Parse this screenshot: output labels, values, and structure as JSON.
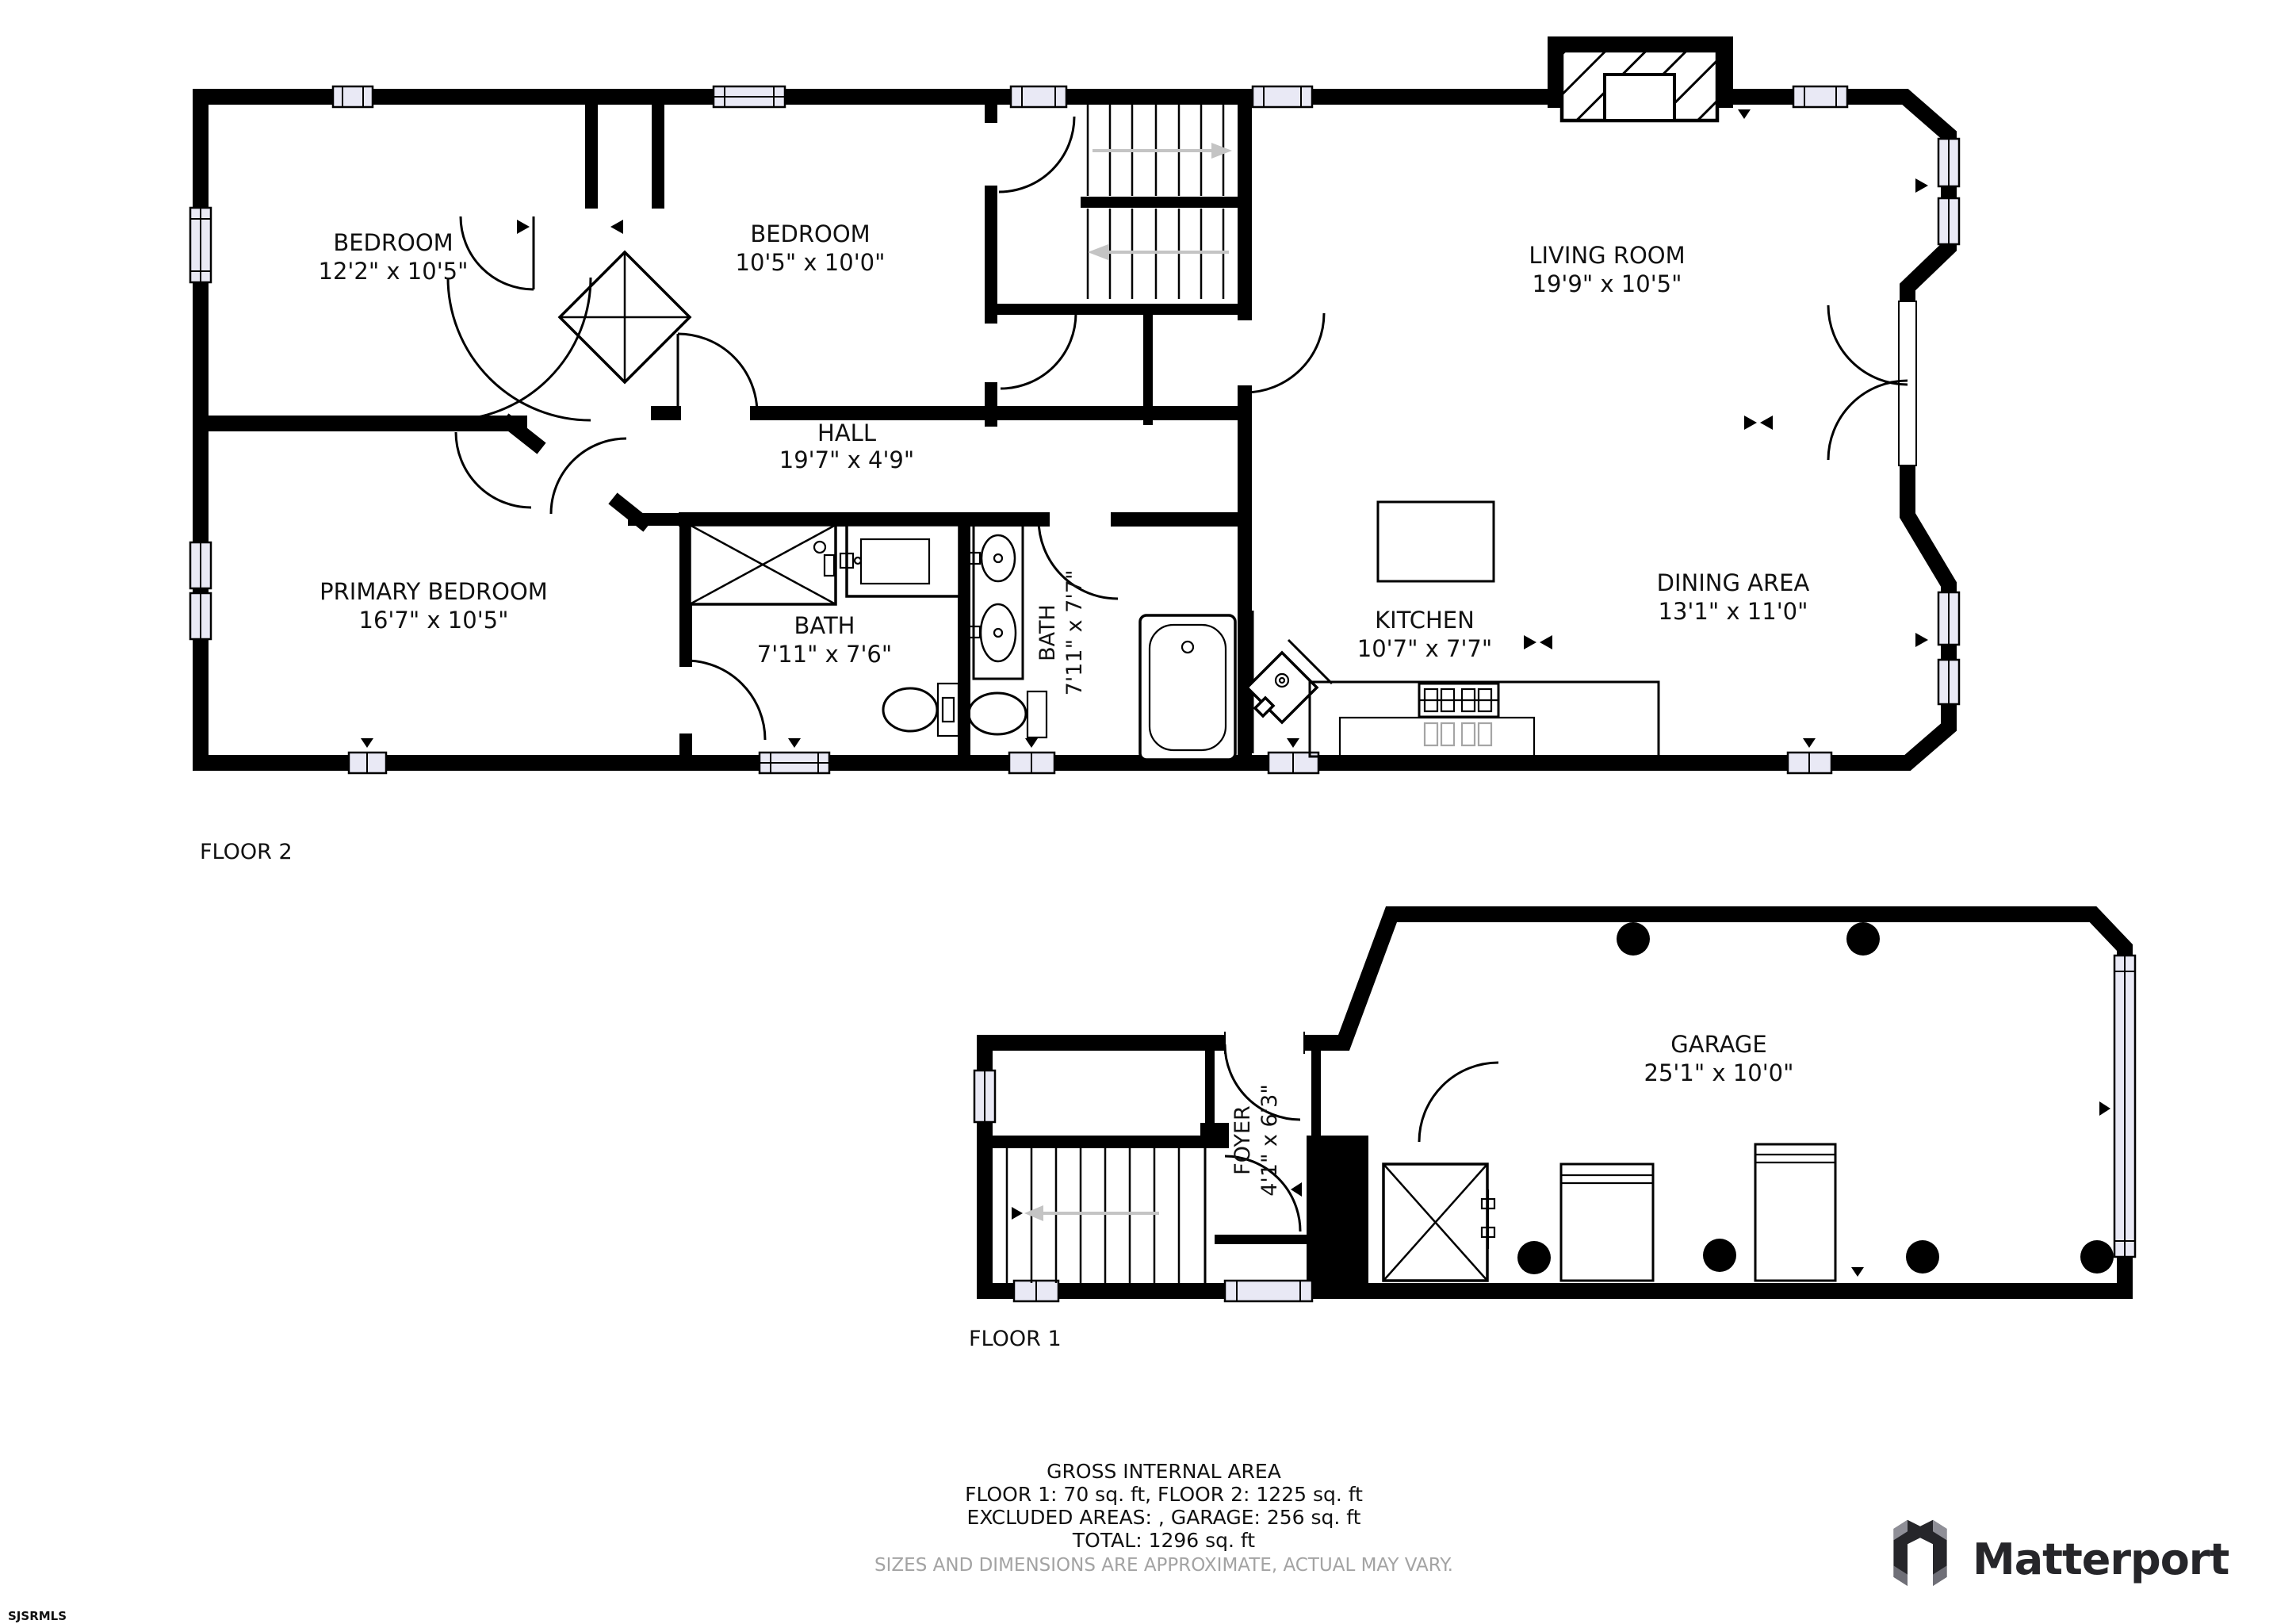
{
  "floor2": {
    "label": "FLOOR 2",
    "rooms": {
      "bedroom1": {
        "name": "BEDROOM",
        "dims": "12'2\" x 10'5\""
      },
      "bedroom2": {
        "name": "BEDROOM",
        "dims": "10'5\" x 10'0\""
      },
      "living": {
        "name": "LIVING ROOM",
        "dims": "19'9\" x 10'5\""
      },
      "hall": {
        "name": "HALL",
        "dims": "19'7\" x 4'9\""
      },
      "primary": {
        "name": "PRIMARY BEDROOM",
        "dims": "16'7\" x 10'5\""
      },
      "bath1": {
        "name": "BATH",
        "dims": "7'11\" x 7'6\""
      },
      "bath2": {
        "name": "BATH",
        "dims": "7'11\" x 7'7\""
      },
      "kitchen": {
        "name": "KITCHEN",
        "dims": "10'7\" x 7'7\""
      },
      "dining": {
        "name": "DINING AREA",
        "dims": "13'1\" x 11'0\""
      }
    }
  },
  "floor1": {
    "label": "FLOOR 1",
    "rooms": {
      "foyer": {
        "name": "FOYER",
        "dims": "4'1\" x 6'3\""
      },
      "garage": {
        "name": "GARAGE",
        "dims": "25'1\" x 10'0\""
      }
    }
  },
  "summary": {
    "title": "GROSS INTERNAL AREA",
    "line1": "FLOOR 1: 70 sq. ft, FLOOR 2: 1225 sq. ft",
    "line2": "EXCLUDED AREAS: , GARAGE: 256 sq. ft",
    "line3": "TOTAL: 1296 sq. ft",
    "disclaimer": "SIZES AND DIMENSIONS ARE APPROXIMATE, ACTUAL MAY VARY."
  },
  "branding": {
    "logo_text": "Matterport",
    "mls_id": "SJSRMLS"
  },
  "colors": {
    "wall": "#000000",
    "window_fill": "#e9e9f5",
    "stair_arrow": "#c4c4c4",
    "disclaimer_gray": "#a3a3a3",
    "logo_dark": "#26262a",
    "logo_gray": "#8f8f97"
  }
}
